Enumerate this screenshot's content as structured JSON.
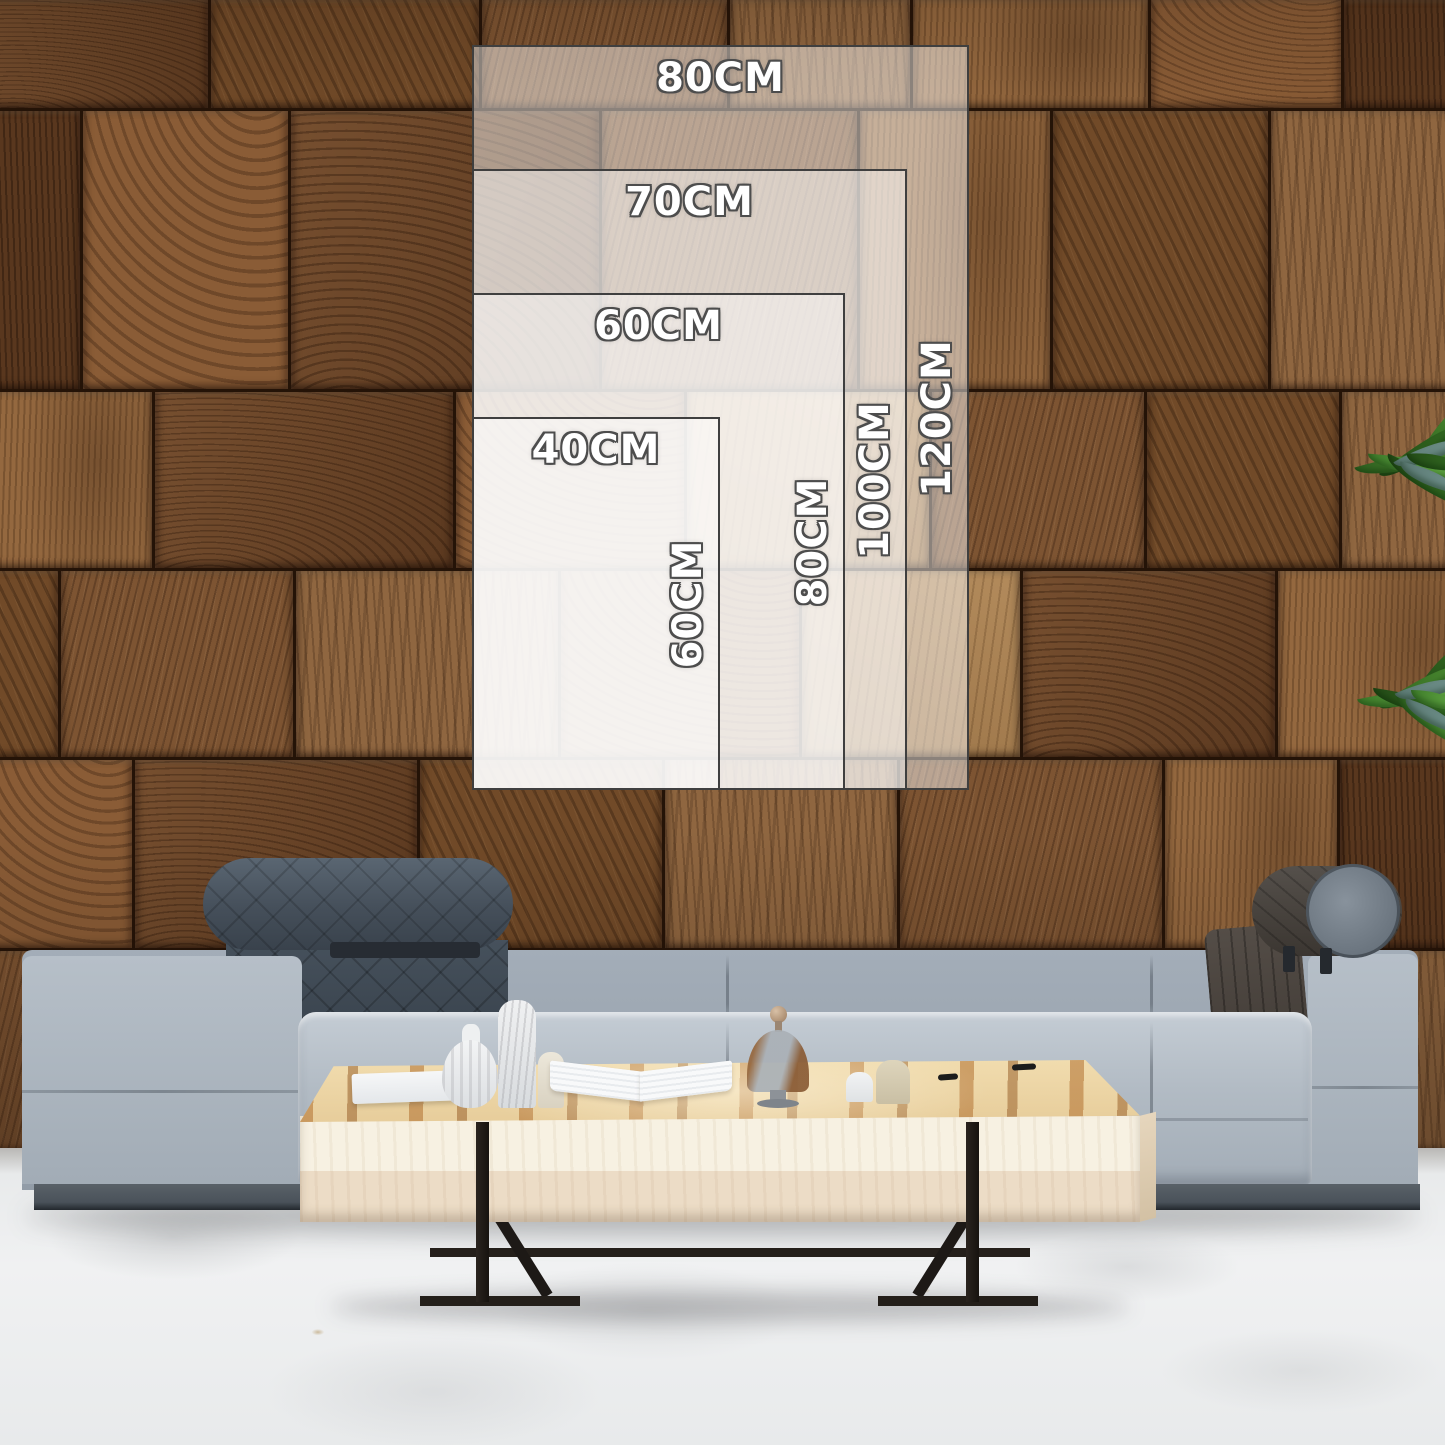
{
  "size_guide": {
    "unit": "CM",
    "sizes": [
      {
        "id": "80x120",
        "width_cm": 80,
        "height_cm": 120,
        "width_label": "80CM",
        "height_label": "120CM"
      },
      {
        "id": "70x100",
        "width_cm": 70,
        "height_cm": 100,
        "width_label": "70CM",
        "height_label": "100CM"
      },
      {
        "id": "60x80",
        "width_cm": 60,
        "height_cm": 80,
        "width_label": "60CM",
        "height_label": "80CM"
      },
      {
        "id": "40x60",
        "width_cm": 40,
        "height_cm": 60,
        "width_label": "40CM",
        "height_label": "60CM"
      }
    ]
  },
  "scene": {
    "colors": {
      "overlay_border": "#3f3f3f",
      "label_fill": "#ffffff",
      "label_outline": "#4d4d4d",
      "wall_wood": "#7a5232",
      "sofa_fabric": "#a9b3be",
      "headrest_dark": "#48525e",
      "bolster_brown": "#4a413a",
      "table_wood": "#eccf9d",
      "table_body": "#f3ecdc",
      "metal_legs": "#1f1b18",
      "floor": "#eaecee",
      "plant_green": "#4f9636"
    }
  }
}
